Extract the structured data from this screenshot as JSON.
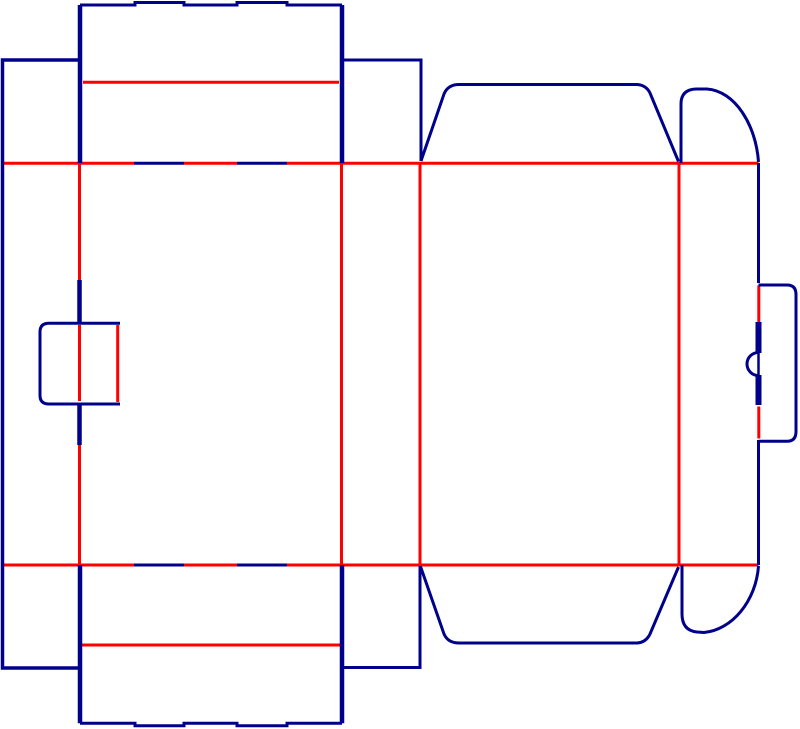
{
  "diagram": {
    "kind": "packaging-dieline",
    "canvas": {
      "width": 800,
      "height": 729
    },
    "palette": {
      "cut": "#00008B",
      "crease": "#FF0000",
      "background": "#FFFFFF"
    },
    "legend": {
      "cut_meaning": "cut line",
      "crease_meaning": "crease line"
    },
    "shapes": [
      {
        "name": "top-fold-crease-left",
        "role": "crease",
        "width": 3,
        "d": "M 2.5 163.3 L 134 163.3"
      },
      {
        "name": "top-fold-crease-mid",
        "role": "crease",
        "width": 3,
        "d": "M 184 163.3 L 237 163.3"
      },
      {
        "name": "top-fold-crease-right",
        "role": "crease",
        "width": 3,
        "d": "M 287 163.3 L 758.5 163.3"
      },
      {
        "name": "bottom-fold-crease-left",
        "role": "crease",
        "width": 3,
        "d": "M 2.5 565 L 134 565"
      },
      {
        "name": "bottom-fold-crease-mid",
        "role": "crease",
        "width": 3,
        "d": "M 184 565 L 237 565"
      },
      {
        "name": "bottom-fold-crease-right",
        "role": "crease",
        "width": 3,
        "d": "M 287 565 L 758.5 565"
      },
      {
        "name": "panel-a-crease-upper",
        "role": "crease",
        "width": 3,
        "d": "M 79.5 163.3 L 79.5 280"
      },
      {
        "name": "panel-a-crease-tab",
        "role": "crease",
        "width": 3,
        "d": "M 79.5 325 L 79.5 401"
      },
      {
        "name": "panel-a-crease-lower",
        "role": "crease",
        "width": 3,
        "d": "M 79.5 445 L 79.5 565"
      },
      {
        "name": "panel-b-crease",
        "role": "crease",
        "width": 3,
        "d": "M 341.5 163.3 L 341.5 565"
      },
      {
        "name": "panel-c-crease",
        "role": "crease",
        "width": 3,
        "d": "M 420 163.3 L 420 565"
      },
      {
        "name": "panel-d-crease",
        "role": "crease",
        "width": 3,
        "d": "M 679 163.3 L 679 565"
      },
      {
        "name": "right-edge-crease-upper",
        "role": "crease",
        "width": 3,
        "d": "M 758.8 285.5 L 758.8 322"
      },
      {
        "name": "right-edge-crease-lower",
        "role": "crease",
        "width": 3,
        "d": "M 758.8 406.5 L 758.8 438.5"
      },
      {
        "name": "top-tuck-flap-crease",
        "role": "crease",
        "width": 3,
        "d": "M 83 82.3 L 339 82.3"
      },
      {
        "name": "bottom-tuck-flap-crease",
        "role": "crease",
        "width": 3,
        "d": "M 82 645 L 340 645"
      },
      {
        "name": "left-lock-tab-crease",
        "role": "crease",
        "width": 3,
        "d": "M 117.7 325 L 117.7 402"
      },
      {
        "name": "top-tuck-flap-edge",
        "role": "cut",
        "width": 3,
        "d": "M 80 5 L 135 5 L 135 2.5 L 184 2.5 L 184 5 L 237 5 L 237 2.5 L 287 2.5 L 287 5 L 342 5"
      },
      {
        "name": "top-tuck-flap-side-left",
        "role": "cut",
        "width": 4.5,
        "d": "M 80 5 L 80 163"
      },
      {
        "name": "top-tuck-flap-side-right",
        "role": "cut",
        "width": 4.5,
        "d": "M 342 5 L 342 163"
      },
      {
        "name": "glue-panel-outline",
        "role": "cut",
        "width": 3.5,
        "d": "M 79 60 L 2.5 60 L 2.5 668 L 79 668"
      },
      {
        "name": "side-top-flap-outline",
        "role": "cut",
        "width": 3,
        "d": "M 343 60 L 421 60 L 421 161"
      },
      {
        "name": "top-dust-flap-outline",
        "role": "cut",
        "width": 3,
        "d": "M 421 161 L 444 94 Q 448 84.5 459 84.5 L 637 84.5 Q 646 85 650 93 L 678.5 161.5"
      },
      {
        "name": "top-ear-flap-outline",
        "role": "cut",
        "width": 3,
        "d": "M 681 163 L 681 104 Q 681 89.5 696 89 L 707 89 C 735 91 756 125 758.5 162"
      },
      {
        "name": "right-edge-cut-upper",
        "role": "cut",
        "width": 3,
        "d": "M 758.5 163 L 758.5 283"
      },
      {
        "name": "right-slit-upper",
        "role": "cut",
        "width": 6,
        "d": "M 758.5 322 L 758.5 353"
      },
      {
        "name": "right-slit-chord",
        "role": "cut",
        "width": 2.5,
        "d": "M 758.5 353 L 758.5 375"
      },
      {
        "name": "thumb-notch-arc",
        "role": "cut",
        "width": 3,
        "d": "M 758.5 352.5 A 10.8 10.8 0 0 0 758.5 375.5"
      },
      {
        "name": "right-slit-lower",
        "role": "cut",
        "width": 6,
        "d": "M 758.5 375 L 758.5 405"
      },
      {
        "name": "right-edge-cut-lower",
        "role": "cut",
        "width": 3,
        "d": "M 758.5 440 L 758.5 565"
      },
      {
        "name": "right-lock-tab-outline",
        "role": "cut",
        "width": 3,
        "d": "M 758.5 285 L 787 285 Q 796 285 796 294.5 L 796 431.5 Q 796 441.3 787 441.3 L 758.5 441.3"
      },
      {
        "name": "left-lock-tab-outline",
        "role": "cut",
        "width": 3,
        "d": "M 120 323.3 L 49 323.3 Q 40 323.3 40 332 L 40 395.5 Q 40 404 49 404 L 120 404"
      },
      {
        "name": "left-slit-upper",
        "role": "cut",
        "width": 4.5,
        "d": "M 79.5 280 L 79.5 324"
      },
      {
        "name": "left-slit-lower",
        "role": "cut",
        "width": 4.5,
        "d": "M 79.5 403 L 79.5 445"
      },
      {
        "name": "fold-cut-top-a",
        "role": "cut",
        "width": 3,
        "d": "M 134 163.3 L 184 163.3"
      },
      {
        "name": "fold-cut-top-b",
        "role": "cut",
        "width": 3,
        "d": "M 237 163.3 L 287 163.3"
      },
      {
        "name": "fold-cut-bottom-a",
        "role": "cut",
        "width": 3,
        "d": "M 134 565 L 184 565"
      },
      {
        "name": "fold-cut-bottom-b",
        "role": "cut",
        "width": 3,
        "d": "M 237 565 L 287 565"
      },
      {
        "name": "bottom-tuck-flap-side-left",
        "role": "cut",
        "width": 4.5,
        "d": "M 80 565 L 80 723.3"
      },
      {
        "name": "bottom-tuck-flap-side-right",
        "role": "cut",
        "width": 4.5,
        "d": "M 342 565 L 342 723.3"
      },
      {
        "name": "bottom-tuck-flap-edge",
        "role": "cut",
        "width": 3,
        "d": "M 80 723.3 L 135 723.3 L 135 725.7 L 184 725.7 L 184 723.3 L 237 723.3 L 237 725.7 L 287 725.7 L 287 723.3 L 342 723.3"
      },
      {
        "name": "side-bottom-flap-outline",
        "role": "cut",
        "width": 3,
        "d": "M 420 566 L 420 667.5 L 343 667.5"
      },
      {
        "name": "bottom-dust-flap-outline",
        "role": "cut",
        "width": 3,
        "d": "M 420.7 567 L 444 634 Q 448 643 459 643 L 637 643 Q 646 642.5 650 634 L 678.5 567"
      },
      {
        "name": "bottom-ear-flap-outline",
        "role": "cut",
        "width": 3,
        "d": "M 682 565 L 682 614 Q 682 630.5 697 632 L 704 632.5 C 732 630 756 601 758.5 566"
      }
    ]
  }
}
